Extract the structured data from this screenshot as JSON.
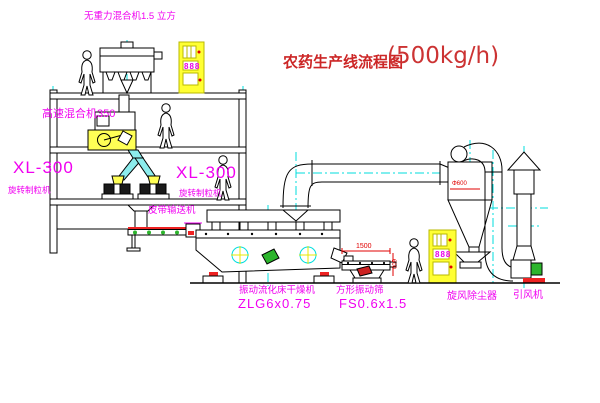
{
  "title": {
    "text": "农药生产线流程图",
    "capacity": "(500kg/h)"
  },
  "equipment_labels": {
    "gravity_free_mixer": "无重力混合机1.5 立方",
    "high_speed_mixer": "高速混合机350",
    "granulator_left": {
      "model": "XL-300",
      "name": "旋转制粒机"
    },
    "granulator_right": {
      "model": "XL-300",
      "name": "旋转制粒机"
    },
    "belt_conveyor": "皮带输送机",
    "fluid_bed_dryer": {
      "name": "振动流化床干燥机",
      "model": "ZLG6x0.75"
    },
    "square_vibrating_sieve": {
      "name": "方形振动筛",
      "model": "FS0.6x1.5"
    },
    "cyclone_dust_collector": "旋风除尘器",
    "induced_draft_fan": "引风机"
  },
  "dimensions": {
    "cyclone_diameter": "Φ600",
    "sieve_length": "1500",
    "sieve_width": "600"
  },
  "control_cabinets": {
    "upper_display": "888",
    "lower_display": "888"
  },
  "colors": {
    "label_magenta": "#f000f0",
    "title_red": "#cc2626",
    "centerline_cyan": "#00dede",
    "highlight_yellow": "#ffff33",
    "accent_green": "#2db52d",
    "accent_red": "#ee2222",
    "line_black": "#000000"
  }
}
